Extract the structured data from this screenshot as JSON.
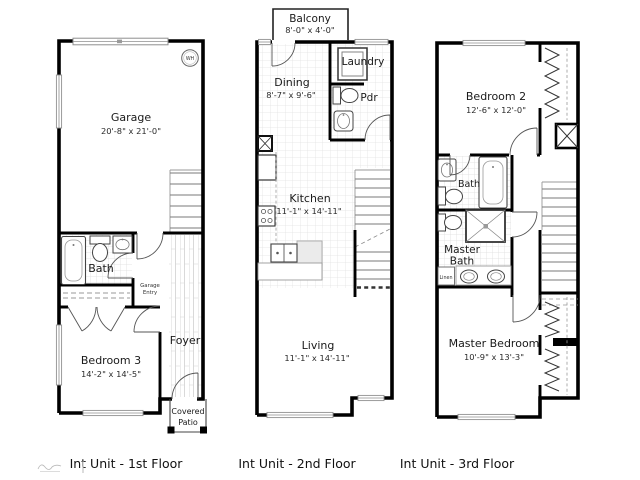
{
  "captions": {
    "first": "Int Unit - 1st Floor",
    "second": "Int Unit - 2nd Floor",
    "third": "Int Unit - 3rd Floor"
  },
  "floors": {
    "first": {
      "garage": {
        "name": "Garage",
        "dims": "20'-8\" x 21'-0\""
      },
      "bath": {
        "name": "Bath"
      },
      "garage_entry": {
        "line1": "Garage",
        "line2": "Entry"
      },
      "bedroom3": {
        "name": "Bedroom 3",
        "dims": "14'-2\" x 14'-5\""
      },
      "foyer": {
        "name": "Foyer"
      },
      "covered_patio": {
        "line1": "Covered",
        "line2": "Patio"
      },
      "water_heater": {
        "label": "WH"
      }
    },
    "second": {
      "balcony": {
        "name": "Balcony",
        "dims": "8'-0\" x 4'-0\""
      },
      "dining": {
        "name": "Dining",
        "dims": "8'-7\" x 9'-6\""
      },
      "laundry": {
        "name": "Laundry"
      },
      "powder": {
        "name": "Pdr"
      },
      "kitchen": {
        "name": "Kitchen",
        "dims": "11'-1\" x 14'-11\""
      },
      "living": {
        "name": "Living",
        "dims": "11'-1\" x 14'-11\""
      }
    },
    "third": {
      "bedroom2": {
        "name": "Bedroom 2",
        "dims": "12'-6\" x 12'-0\""
      },
      "bath": {
        "name": "Bath"
      },
      "master_bath": {
        "line1": "Master",
        "line2": "Bath"
      },
      "linen": {
        "name": "Linen"
      },
      "master_bedroom": {
        "name": "Master Bedroom",
        "dims": "10'-9\" x 13'-3\""
      }
    }
  },
  "colors": {
    "wall": "#000000",
    "window_frame": "#8f8f8f",
    "tile_line": "#e2e2e2",
    "stair_tread": "#7a7a7a",
    "text": "#1a1a1a"
  }
}
